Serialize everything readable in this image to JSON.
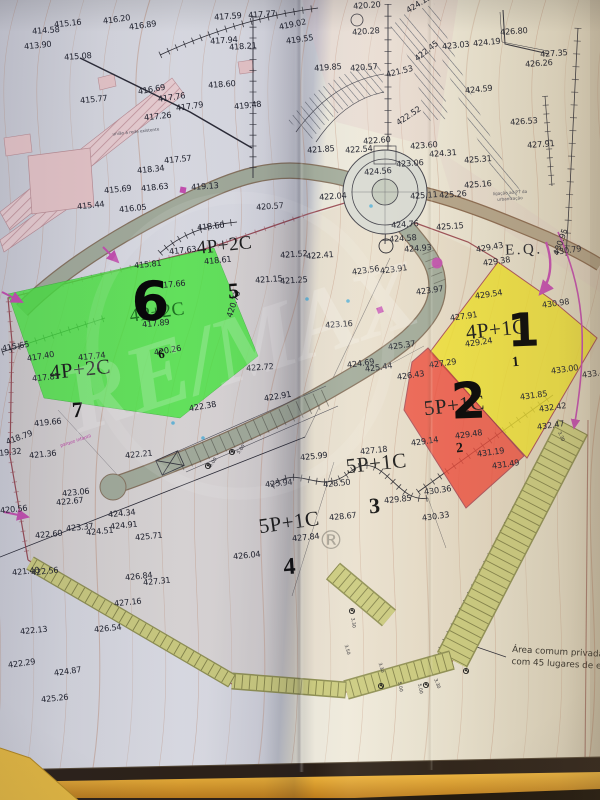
{
  "map": {
    "lots": [
      {
        "number": "1",
        "type": "4P+1C"
      },
      {
        "number": "2",
        "type": "5P+1C"
      },
      {
        "number": "3",
        "type": "5P+1C"
      },
      {
        "number": "4",
        "type": "5P+1C"
      },
      {
        "number": "5",
        "type": "4P+2C"
      },
      {
        "number": "6",
        "type": "4P+2C"
      },
      {
        "number": "7",
        "type": "4P+2C"
      }
    ],
    "highlight_colors": {
      "lot1": "#f0e22c",
      "lot2": "#ef4a3a",
      "lot6": "#46e93e"
    },
    "annotations": {
      "eq": "E.Q.",
      "note_line1": "Área comum privada dos",
      "note_line2": "com 45 lugares de estaci",
      "tiny_road_note": "união à rede existente",
      "tiny_pt_note1": "ligação ao PT da",
      "tiny_pt_note2": "urbanização",
      "playground": "parque infantil"
    },
    "watermark": {
      "brand": "RE/MAX",
      "registered": "®"
    },
    "elevations": [
      {
        "t": "415.16",
        "x": 68,
        "y": 26,
        "r": -6
      },
      {
        "t": "416.20",
        "x": 117,
        "y": 22,
        "r": -8
      },
      {
        "t": "416.89",
        "x": 143,
        "y": 28,
        "r": -8
      },
      {
        "t": "414.58",
        "x": 46,
        "y": 33,
        "r": -4
      },
      {
        "t": "413.90",
        "x": 38,
        "y": 48,
        "r": -6
      },
      {
        "t": "415.08",
        "x": 78,
        "y": 59,
        "r": -4
      },
      {
        "t": "417.59",
        "x": 228,
        "y": 19,
        "r": -4
      },
      {
        "t": "417.77",
        "x": 262,
        "y": 17,
        "r": -4
      },
      {
        "t": "419.02",
        "x": 293,
        "y": 27,
        "r": -12
      },
      {
        "t": "420.20",
        "x": 367,
        "y": 8,
        "r": -4
      },
      {
        "t": "424.13",
        "x": 420,
        "y": 6,
        "r": -32
      },
      {
        "t": "417.94",
        "x": 224,
        "y": 43,
        "r": -4
      },
      {
        "t": "418.21",
        "x": 243,
        "y": 49,
        "r": -4
      },
      {
        "t": "419.55",
        "x": 300,
        "y": 42,
        "r": -8
      },
      {
        "t": "420.28",
        "x": 366,
        "y": 34,
        "r": -4
      },
      {
        "t": "419.85",
        "x": 328,
        "y": 70,
        "r": -4
      },
      {
        "t": "420.57",
        "x": 364,
        "y": 70,
        "r": -4
      },
      {
        "t": "421.53",
        "x": 400,
        "y": 74,
        "r": -14
      },
      {
        "t": "423.03",
        "x": 456,
        "y": 48,
        "r": -6
      },
      {
        "t": "424.19",
        "x": 487,
        "y": 45,
        "r": -6
      },
      {
        "t": "426.80",
        "x": 514,
        "y": 34,
        "r": -4
      },
      {
        "t": "427.35",
        "x": 554,
        "y": 56,
        "r": -4
      },
      {
        "t": "426.26",
        "x": 539,
        "y": 66,
        "r": -4
      },
      {
        "t": "422.45",
        "x": 428,
        "y": 53,
        "r": -38
      },
      {
        "t": "424.59",
        "x": 479,
        "y": 92,
        "r": -6
      },
      {
        "t": "426.53",
        "x": 524,
        "y": 124,
        "r": -4
      },
      {
        "t": "427.91",
        "x": 541,
        "y": 147,
        "r": -4
      },
      {
        "t": "422.52",
        "x": 410,
        "y": 118,
        "r": -34
      },
      {
        "t": "418.60",
        "x": 222,
        "y": 87,
        "r": -4
      },
      {
        "t": "419.48",
        "x": 248,
        "y": 108,
        "r": -6
      },
      {
        "t": "416.69",
        "x": 152,
        "y": 92,
        "r": -10
      },
      {
        "t": "415.77",
        "x": 94,
        "y": 102,
        "r": -6
      },
      {
        "t": "417.76",
        "x": 172,
        "y": 100,
        "r": -8
      },
      {
        "t": "417.79",
        "x": 190,
        "y": 109,
        "r": -8
      },
      {
        "t": "417.26",
        "x": 158,
        "y": 119,
        "r": -6
      },
      {
        "t": "418.34",
        "x": 151,
        "y": 172,
        "r": -6
      },
      {
        "t": "418.63",
        "x": 155,
        "y": 190,
        "r": -6
      },
      {
        "t": "415.69",
        "x": 118,
        "y": 192,
        "r": -6
      },
      {
        "t": "415.44",
        "x": 91,
        "y": 208,
        "r": -6
      },
      {
        "t": "416.05",
        "x": 133,
        "y": 211,
        "r": -6
      },
      {
        "t": "417.57",
        "x": 178,
        "y": 162,
        "r": -6
      },
      {
        "t": "419.13",
        "x": 205,
        "y": 189,
        "r": -4
      },
      {
        "t": "420.57",
        "x": 270,
        "y": 209,
        "r": -4
      },
      {
        "t": "421.85",
        "x": 321,
        "y": 152,
        "r": -4
      },
      {
        "t": "422.60",
        "x": 377,
        "y": 143,
        "r": -4
      },
      {
        "t": "422.54",
        "x": 359,
        "y": 152,
        "r": -4
      },
      {
        "t": "423.60",
        "x": 424,
        "y": 148,
        "r": -4
      },
      {
        "t": "423.06",
        "x": 410,
        "y": 166,
        "r": -4
      },
      {
        "t": "424.56",
        "x": 378,
        "y": 174,
        "r": -4
      },
      {
        "t": "424.31",
        "x": 443,
        "y": 156,
        "r": -4
      },
      {
        "t": "425.31",
        "x": 478,
        "y": 162,
        "r": -4
      },
      {
        "t": "425.16",
        "x": 478,
        "y": 187,
        "r": -4
      },
      {
        "t": "425.26",
        "x": 453,
        "y": 197,
        "r": -4
      },
      {
        "t": "425.11",
        "x": 424,
        "y": 198,
        "r": -4
      },
      {
        "t": "422.04",
        "x": 333,
        "y": 199,
        "r": -4
      },
      {
        "t": "424.76",
        "x": 405,
        "y": 227,
        "r": -4
      },
      {
        "t": "425.15",
        "x": 450,
        "y": 229,
        "r": -4
      },
      {
        "t": "424.58",
        "x": 403,
        "y": 241,
        "r": -4
      },
      {
        "t": "424.93",
        "x": 418,
        "y": 251,
        "r": -4
      },
      {
        "t": "429.43",
        "x": 490,
        "y": 250,
        "r": -10
      },
      {
        "t": "429.38",
        "x": 497,
        "y": 264,
        "r": -8
      },
      {
        "t": "430.95",
        "x": 563,
        "y": 243,
        "r": -70
      },
      {
        "t": "430.79",
        "x": 568,
        "y": 253,
        "r": -8
      },
      {
        "t": "430.98",
        "x": 556,
        "y": 306,
        "r": -8
      },
      {
        "t": "429.54",
        "x": 489,
        "y": 297,
        "r": -8
      },
      {
        "t": "427.91",
        "x": 464,
        "y": 319,
        "r": -8
      },
      {
        "t": "429.24",
        "x": 479,
        "y": 345,
        "r": -8
      },
      {
        "t": "433.00",
        "x": 565,
        "y": 372,
        "r": -8
      },
      {
        "t": "433.43",
        "x": 596,
        "y": 376,
        "r": -8
      },
      {
        "t": "423.97",
        "x": 430,
        "y": 293,
        "r": -8
      },
      {
        "t": "421.52",
        "x": 294,
        "y": 257,
        "r": -4
      },
      {
        "t": "422.41",
        "x": 320,
        "y": 258,
        "r": -4
      },
      {
        "t": "421.15",
        "x": 269,
        "y": 282,
        "r": -4
      },
      {
        "t": "421.25",
        "x": 294,
        "y": 283,
        "r": -4
      },
      {
        "t": "423.56",
        "x": 366,
        "y": 273,
        "r": -8
      },
      {
        "t": "423.91",
        "x": 394,
        "y": 272,
        "r": -8
      },
      {
        "t": "423.16",
        "x": 339,
        "y": 327,
        "r": -4
      },
      {
        "t": "422.72",
        "x": 260,
        "y": 370,
        "r": -4
      },
      {
        "t": "425.37",
        "x": 402,
        "y": 348,
        "r": -8
      },
      {
        "t": "424.69",
        "x": 361,
        "y": 366,
        "r": -8
      },
      {
        "t": "425.44",
        "x": 379,
        "y": 370,
        "r": -8
      },
      {
        "t": "426.43",
        "x": 411,
        "y": 378,
        "r": -8
      },
      {
        "t": "427.29",
        "x": 443,
        "y": 366,
        "r": -8
      },
      {
        "t": "431.85",
        "x": 534,
        "y": 398,
        "r": -8
      },
      {
        "t": "432.42",
        "x": 553,
        "y": 410,
        "r": -8
      },
      {
        "t": "432.47",
        "x": 551,
        "y": 428,
        "r": -8
      },
      {
        "t": "429.48",
        "x": 469,
        "y": 437,
        "r": -8
      },
      {
        "t": "431.19",
        "x": 491,
        "y": 455,
        "r": -8
      },
      {
        "t": "431.49",
        "x": 506,
        "y": 467,
        "r": -8
      },
      {
        "t": "429.14",
        "x": 425,
        "y": 444,
        "r": -8
      },
      {
        "t": "430.36",
        "x": 438,
        "y": 493,
        "r": -8
      },
      {
        "t": "430.33",
        "x": 436,
        "y": 519,
        "r": -8
      },
      {
        "t": "427.18",
        "x": 374,
        "y": 453,
        "r": -6
      },
      {
        "t": "425.99",
        "x": 314,
        "y": 459,
        "r": -6
      },
      {
        "t": "425.94",
        "x": 279,
        "y": 486,
        "r": -6
      },
      {
        "t": "428.50",
        "x": 337,
        "y": 486,
        "r": -6
      },
      {
        "t": "429.85",
        "x": 398,
        "y": 502,
        "r": -6
      },
      {
        "t": "428.67",
        "x": 343,
        "y": 519,
        "r": -6
      },
      {
        "t": "427.84",
        "x": 306,
        "y": 540,
        "r": -6
      },
      {
        "t": "426.04",
        "x": 247,
        "y": 558,
        "r": -6
      },
      {
        "t": "422.38",
        "x": 203,
        "y": 409,
        "r": -10
      },
      {
        "t": "422.91",
        "x": 278,
        "y": 399,
        "r": -10
      },
      {
        "t": "422.21",
        "x": 139,
        "y": 457,
        "r": -6
      },
      {
        "t": "421.36",
        "x": 43,
        "y": 457,
        "r": -6
      },
      {
        "t": "419.32",
        "x": 8,
        "y": 455,
        "r": -6
      },
      {
        "t": "418.79",
        "x": 20,
        "y": 440,
        "r": -20
      },
      {
        "t": "419.66",
        "x": 48,
        "y": 425,
        "r": -6
      },
      {
        "t": "417.81",
        "x": 46,
        "y": 380,
        "r": -6
      },
      {
        "t": "417.40",
        "x": 41,
        "y": 359,
        "r": -10
      },
      {
        "t": "415.65",
        "x": 16,
        "y": 349,
        "r": -10
      },
      {
        "t": "417.74",
        "x": 92,
        "y": 359,
        "r": -6
      },
      {
        "t": "420.73",
        "x": 236,
        "y": 305,
        "r": -72
      },
      {
        "t": "420.26",
        "x": 168,
        "y": 353,
        "r": -10
      },
      {
        "t": "415.81",
        "x": 148,
        "y": 267,
        "r": -6
      },
      {
        "t": "417.66",
        "x": 172,
        "y": 287,
        "r": -6
      },
      {
        "t": "417.89",
        "x": 156,
        "y": 326,
        "r": -6
      },
      {
        "t": "417.63",
        "x": 183,
        "y": 253,
        "r": -6
      },
      {
        "t": "418.60",
        "x": 211,
        "y": 229,
        "r": -6
      },
      {
        "t": "418.61",
        "x": 218,
        "y": 263,
        "r": -6
      },
      {
        "t": "420.56",
        "x": 14,
        "y": 512,
        "r": -6
      },
      {
        "t": "423.06",
        "x": 76,
        "y": 495,
        "r": -6
      },
      {
        "t": "422.67",
        "x": 70,
        "y": 504,
        "r": -6
      },
      {
        "t": "422.60",
        "x": 49,
        "y": 537,
        "r": -6
      },
      {
        "t": "423.37",
        "x": 80,
        "y": 530,
        "r": -6
      },
      {
        "t": "424.51",
        "x": 100,
        "y": 534,
        "r": -6
      },
      {
        "t": "424.34",
        "x": 122,
        "y": 516,
        "r": -6
      },
      {
        "t": "424.91",
        "x": 124,
        "y": 528,
        "r": -6
      },
      {
        "t": "425.71",
        "x": 149,
        "y": 539,
        "r": -6
      },
      {
        "t": "421.40",
        "x": 26,
        "y": 574,
        "r": -6
      },
      {
        "t": "422.56",
        "x": 45,
        "y": 574,
        "r": -6
      },
      {
        "t": "426.84",
        "x": 139,
        "y": 579,
        "r": -6
      },
      {
        "t": "427.31",
        "x": 157,
        "y": 584,
        "r": -6
      },
      {
        "t": "427.16",
        "x": 128,
        "y": 605,
        "r": -6
      },
      {
        "t": "426.54",
        "x": 108,
        "y": 631,
        "r": -6
      },
      {
        "t": "422.13",
        "x": 34,
        "y": 633,
        "r": -6
      },
      {
        "t": "422.29",
        "x": 22,
        "y": 666,
        "r": -8
      },
      {
        "t": "424.87",
        "x": 68,
        "y": 674,
        "r": -8
      },
      {
        "t": "425.26",
        "x": 55,
        "y": 701,
        "r": -6
      }
    ],
    "dims": [
      {
        "t": "3.30",
        "x": 352,
        "y": 623,
        "r": 80
      },
      {
        "t": "3.50",
        "x": 346,
        "y": 650,
        "r": 75
      },
      {
        "t": "3.30",
        "x": 380,
        "y": 668,
        "r": 75
      },
      {
        "t": "5.00",
        "x": 399,
        "y": 687,
        "r": 78
      },
      {
        "t": "5.00",
        "x": 419,
        "y": 689,
        "r": 78
      },
      {
        "t": "3.30",
        "x": 436,
        "y": 684,
        "r": 70
      },
      {
        "t": "5.00",
        "x": 214,
        "y": 463,
        "r": -55
      },
      {
        "t": "5.00",
        "x": 242,
        "y": 450,
        "r": -55
      },
      {
        "t": "3.30",
        "x": 560,
        "y": 437,
        "r": 65
      }
    ]
  }
}
